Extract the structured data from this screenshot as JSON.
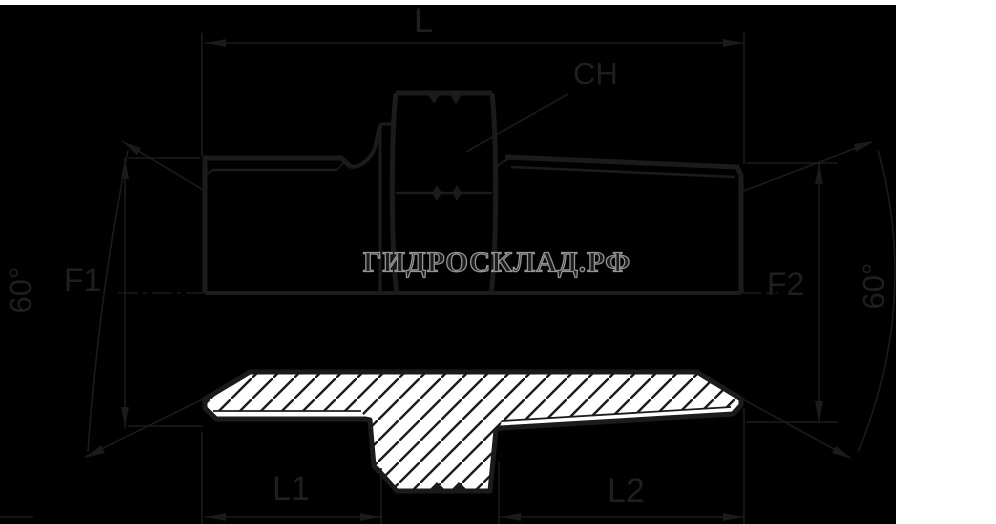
{
  "diagram": {
    "kind": "technical-drawing",
    "labels": {
      "overall_length": "L",
      "wrench_size": "CH",
      "thread_left": "F1",
      "thread_right": "F2",
      "thread_length_left": "L1",
      "thread_length_right": "L2",
      "cone_angle_left": "60°",
      "cone_angle_right": "60°"
    }
  },
  "watermark": {
    "text": "ГИДРОСКЛАД.РФ",
    "stroke_color": "#949494"
  },
  "colors": {
    "background": "#000000",
    "line": "#1b1b1b",
    "label_text": "#1f1f1f",
    "section_fill": "#ffffff",
    "page_margin": "#ffffff"
  }
}
